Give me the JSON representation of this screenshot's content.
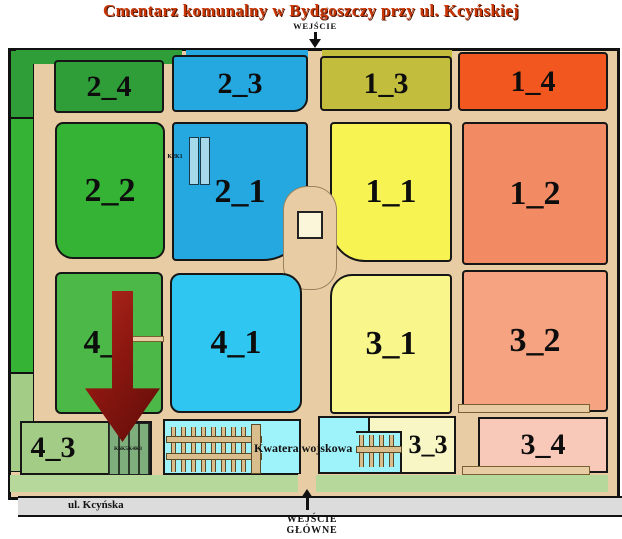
{
  "title": "Cmentarz komunalny w Bydgoszczy przy ul. Kcyńskiej",
  "labels": {
    "entrance_top": "WEJŚCIE",
    "entrance_main_line1": "WEJŚCIE",
    "entrance_main_line2": "GŁÓWNE",
    "street": "ul. Kcyńska",
    "military": "Kwatera wojskowa",
    "k2k1": "K2K1",
    "k6k5k4k3": "K6K5K4K3"
  },
  "colors": {
    "title": "#c83705",
    "path": "#e8cda4",
    "road": "#dcdcdc",
    "building": "#fbf5da",
    "bottom_strip": "#b7d89b",
    "military_cyan": "#9ef2fa",
    "grid_bar": "#d9bd8c",
    "k2k1_bar": "#a6d9ea",
    "arrow_red": "#8c1710"
  },
  "sections": {
    "s2_4": {
      "label": "2_4",
      "color": "#2f9e38"
    },
    "s2_3": {
      "label": "2_3",
      "color": "#25a7e0"
    },
    "s1_3": {
      "label": "1_3",
      "color": "#c2bd3d"
    },
    "s1_4": {
      "label": "1_4",
      "color": "#f2571f"
    },
    "s2_2": {
      "label": "2_2",
      "color": "#35b335"
    },
    "s2_1": {
      "label": "2_1",
      "color": "#25a7e0"
    },
    "s1_1": {
      "label": "1_1",
      "color": "#f7f353"
    },
    "s1_2": {
      "label": "1_2",
      "color": "#f28a63"
    },
    "s4_2": {
      "label": "4_2",
      "color": "#4cb848"
    },
    "s4_1": {
      "label": "4_1",
      "color": "#30c6f2"
    },
    "s3_1": {
      "label": "3_1",
      "color": "#f9f78c"
    },
    "s3_2": {
      "label": "3_2",
      "color": "#f6a381"
    },
    "s4_3": {
      "label": "4_3",
      "color": "#a3cd87"
    },
    "s3_3": {
      "label": "3_3",
      "color": "#f9f6c5"
    },
    "s3_4": {
      "label": "3_4",
      "color": "#f8c8b8"
    }
  }
}
